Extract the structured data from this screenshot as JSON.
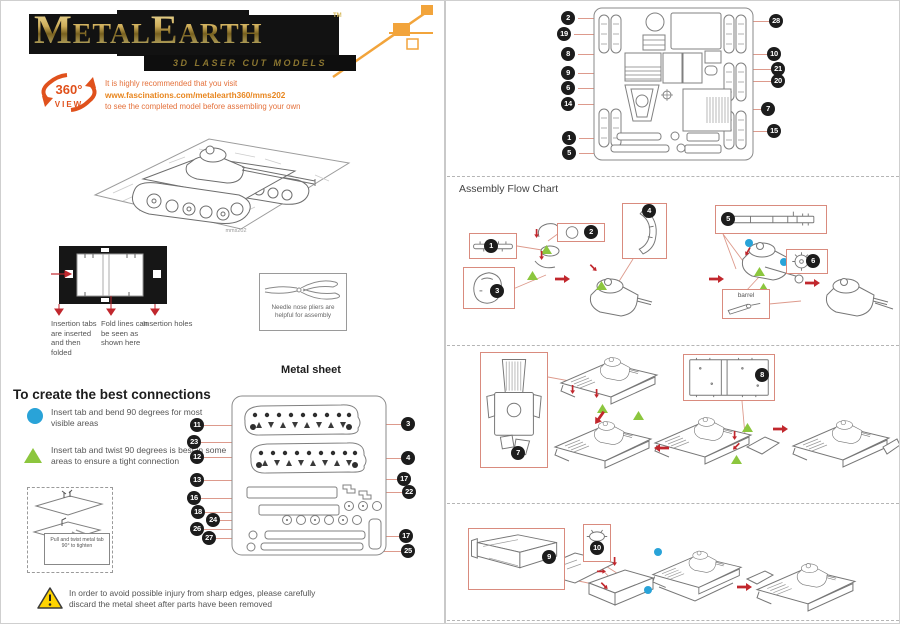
{
  "logo": {
    "title": "MetalEarth",
    "tm": "TM",
    "subtitle": "3D LASER CUT MODELS"
  },
  "view360": {
    "badge_top": "360°",
    "badge_bottom": "VIEW",
    "line1": "It is highly recommended that you visit",
    "line2": "www.fascinations.com/metalearth360/mms202",
    "line3": "to see the completed model before assembling your own"
  },
  "sheet_preview": {
    "caption": "mms202"
  },
  "insertion_guide": {
    "label_tabs": "Insertion tabs are inserted and then folded",
    "label_fold": "Fold lines can be seen as shown here",
    "label_holes": "Insertion holes"
  },
  "pliers_box": {
    "text": "Needle nose pliers are helpful for assembly"
  },
  "connections": {
    "heading": "To create the best connections",
    "bend_rule": "Insert tab and bend 90 degrees for most visible areas",
    "twist_rule": "Insert tab and twist 90 degrees is best in some areas to ensure a tight connection",
    "twist_note": "Pull and twist metal tab 90° to tighten"
  },
  "metal_sheet": {
    "title": "Metal sheet",
    "left_callouts": [
      "11",
      "23",
      "12",
      "13",
      "16",
      "18",
      "24",
      "26",
      "27"
    ],
    "right_callouts": [
      "3",
      "4",
      "17",
      "22",
      "17",
      "25"
    ]
  },
  "parts_sheet": {
    "left_callouts": [
      "2",
      "19",
      "8",
      "9",
      "6",
      "14",
      "1",
      "5"
    ],
    "right_callouts": [
      "28",
      "10",
      "21",
      "20",
      "7",
      "15"
    ]
  },
  "assembly": {
    "title": "Assembly Flow Chart",
    "barrel_label": "barrel",
    "row1_callouts": [
      "1",
      "2",
      "3",
      "4",
      "5",
      "6"
    ],
    "row2_callouts": [
      "7",
      "8"
    ],
    "row3_callouts": [
      "9",
      "10"
    ]
  },
  "warning": {
    "line1": "In order to avoid possible injury from sharp edges, please carefully",
    "line2": "discard the metal sheet after parts have been removed"
  },
  "colors": {
    "accent_orange": "#f2a43b",
    "badge_orange": "#e0511c",
    "note_orange": "#e4703a",
    "url_orange": "#e8861f",
    "leader_salmon": "#dd9a8c",
    "arrow_red": "#c1272d",
    "twist_green": "#8cc63e",
    "bend_blue": "#29a3d8",
    "callout_black": "#1c1c1c",
    "logo_gold": "#cfae5a"
  }
}
